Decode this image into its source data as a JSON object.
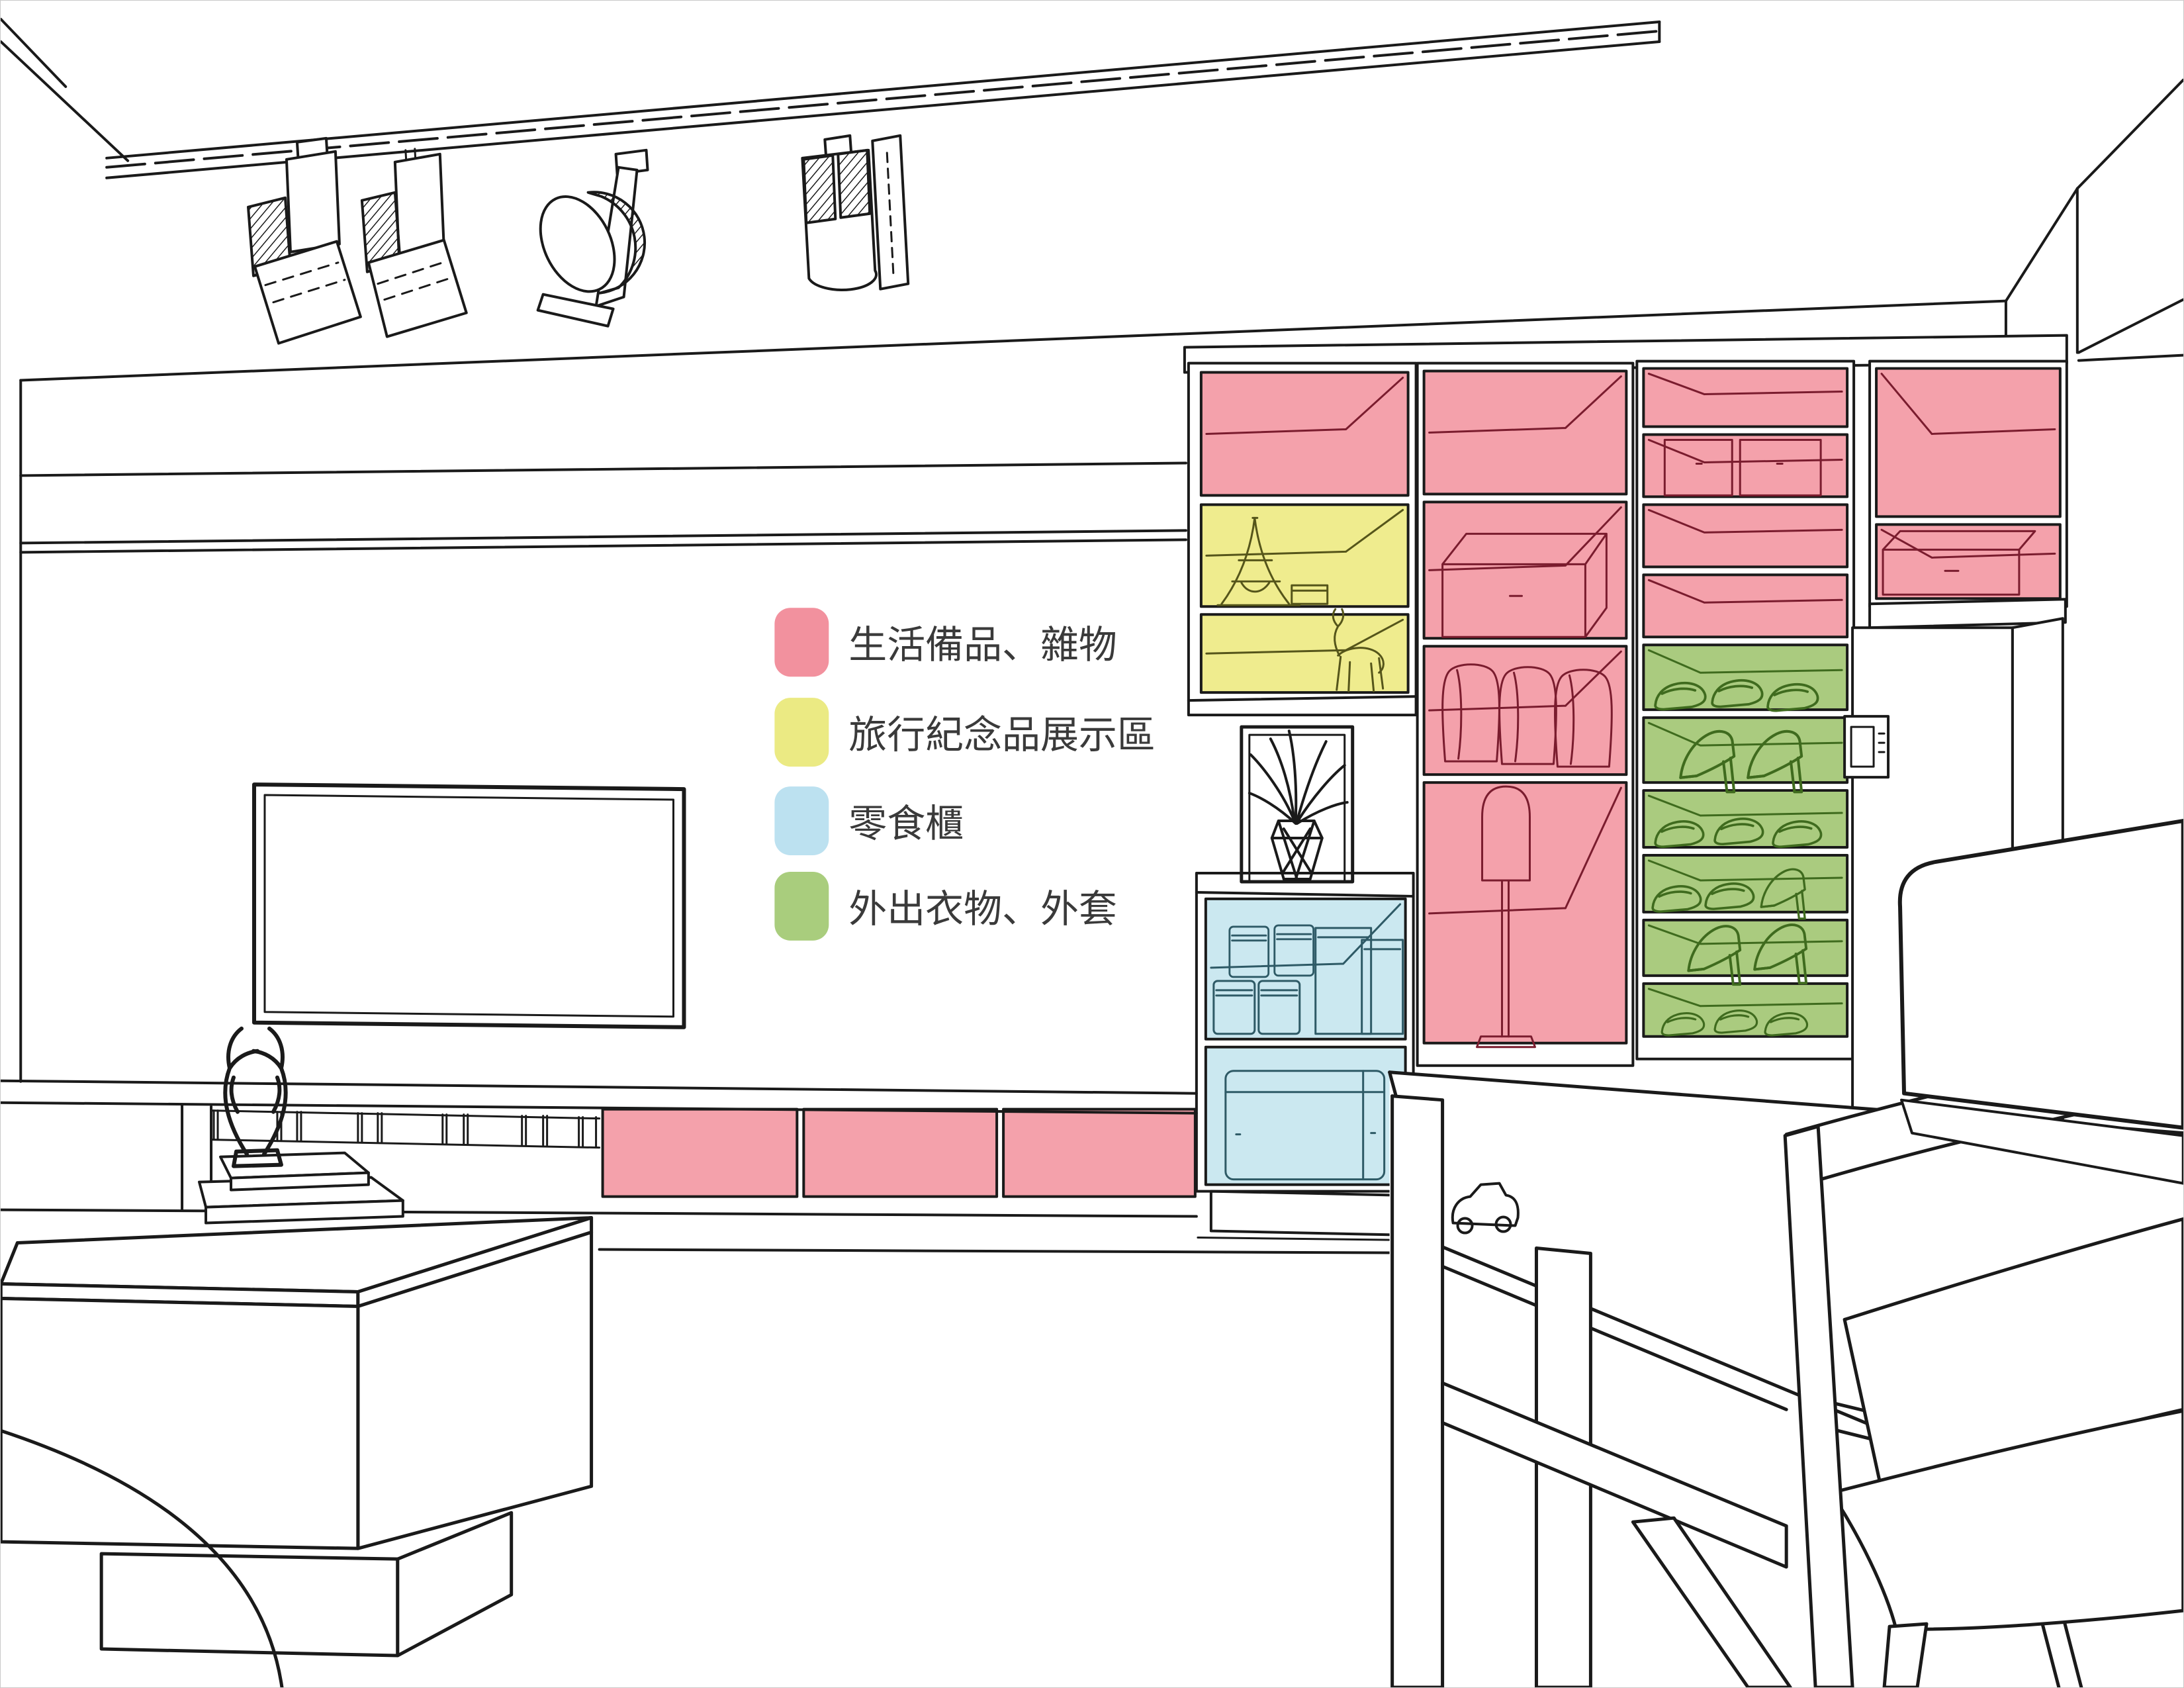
{
  "legend": {
    "items": [
      {
        "id": "living-misc",
        "label": "生活備品、雜物",
        "swatch_color": "#F2919E"
      },
      {
        "id": "souvenir-display",
        "label": "旅行紀念品展示區",
        "swatch_color": "#EBEA83"
      },
      {
        "id": "snack-cabinet",
        "label": "零食櫃",
        "swatch_color": "#BCE1F0"
      },
      {
        "id": "outerwear",
        "label": "外出衣物、外套",
        "swatch_color": "#A9CD7D"
      }
    ]
  },
  "zones": {
    "living_misc": {
      "label": "生活備品、雜物",
      "fill": "#F4A1AB",
      "line": "#7A1C2E"
    },
    "souvenir": {
      "label": "旅行紀念品展示區",
      "fill": "#EFEC8E",
      "line": "#55551A"
    },
    "snack": {
      "label": "零食櫃",
      "fill": "#CBE8F0",
      "line": "#2E5A66"
    },
    "outerwear": {
      "label": "外出衣物、外套",
      "fill": "#AACB7F",
      "line": "#3F6B1E"
    }
  },
  "scene": {
    "ink": "#1a1a1a",
    "background": "#ffffff",
    "border": "#c9c9c9"
  }
}
